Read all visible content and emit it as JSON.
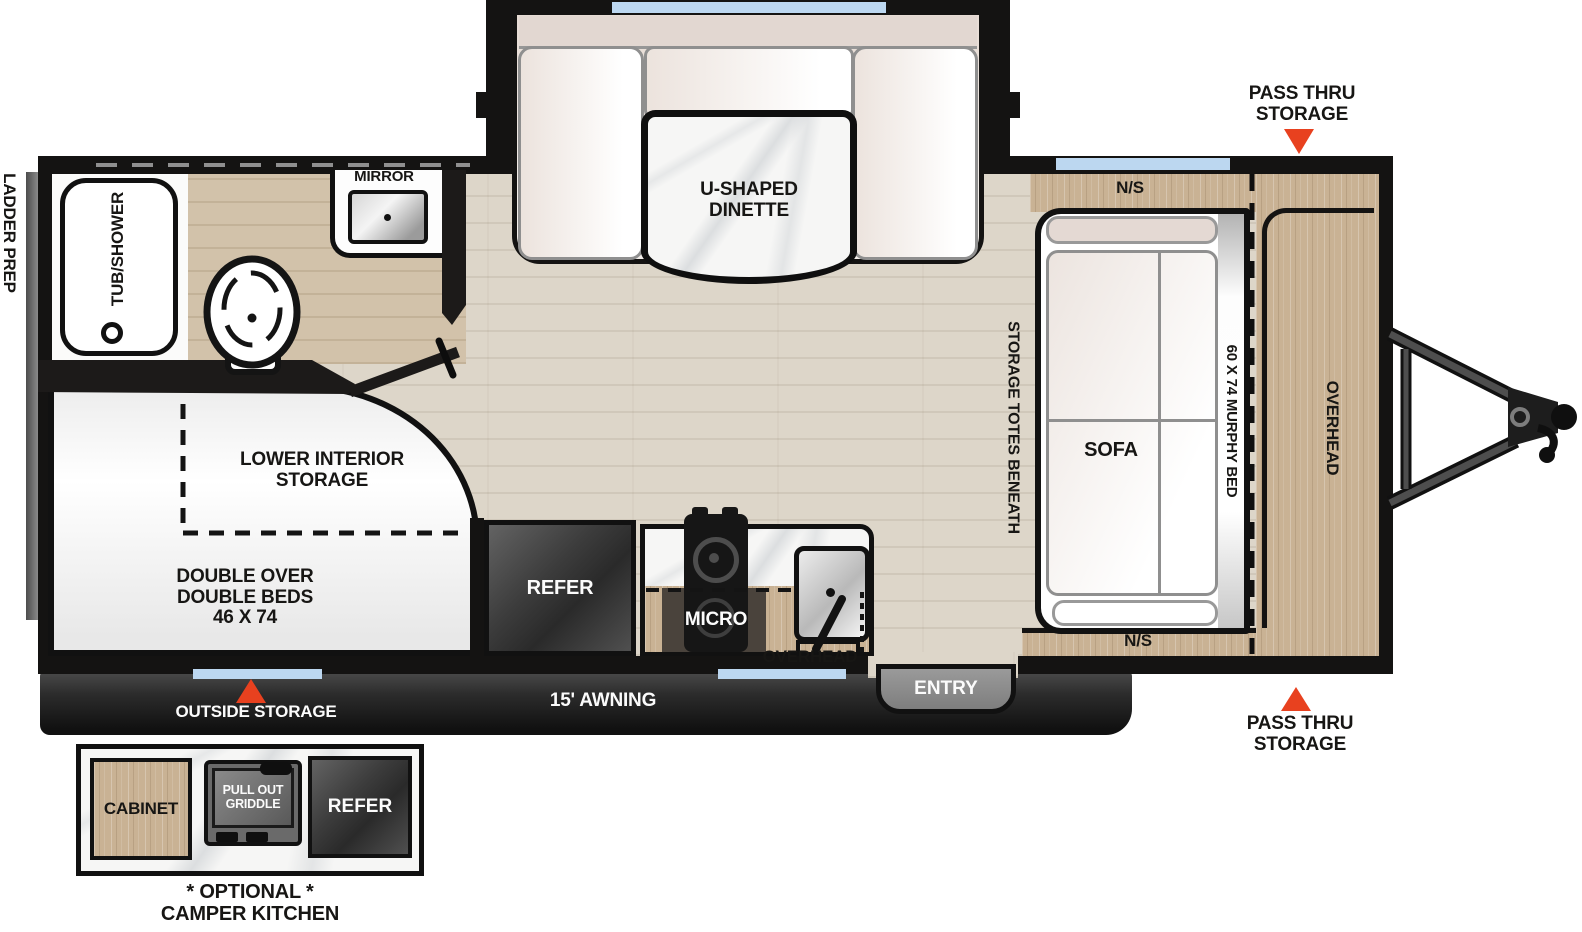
{
  "colors": {
    "accent": "#e8411f",
    "window": "#bcd7f0",
    "wall": "#141312",
    "wood": "#c9b294",
    "floor": "#ddd6c9",
    "awning-dark": "#1d1d1d",
    "entry-gray": "#8d8d8d"
  },
  "exterior": {
    "ladder_prep": "LADDER PREP",
    "pass_thru_top": {
      "line1": "PASS THRU",
      "line2": "STORAGE"
    },
    "pass_thru_bottom": {
      "line1": "PASS THRU",
      "line2": "STORAGE"
    },
    "outside_storage": "OUTSIDE STORAGE",
    "awning": "15' AWNING",
    "entry": "ENTRY"
  },
  "bathroom": {
    "tub": "TUB/SHOWER",
    "mirror": "MIRROR"
  },
  "dinette": {
    "line1": "U-SHAPED",
    "line2": "DINETTE"
  },
  "bedroom": {
    "ns_top": "N/S",
    "ns_bottom": "N/S",
    "murphy_bed": "60 X 74 MURPHY BED",
    "sofa": "SOFA",
    "overhead": "OVERHEAD",
    "storage_totes": "STORAGE TOTES BENEATH"
  },
  "bunk": {
    "storage_line1": "LOWER INTERIOR",
    "storage_line2": "STORAGE",
    "bed_line1": "DOUBLE OVER",
    "bed_line2": "DOUBLE BEDS",
    "bed_line3": "46 X 74"
  },
  "kitchen": {
    "refer": "REFER",
    "micro": "MICRO",
    "overhead": "OVERHEAD"
  },
  "camper_kitchen": {
    "cabinet": "CABINET",
    "griddle_line1": "PULL OUT",
    "griddle_line2": "GRIDDLE",
    "refer": "REFER",
    "caption_line1": "* OPTIONAL *",
    "caption_line2": "CAMPER KITCHEN"
  }
}
